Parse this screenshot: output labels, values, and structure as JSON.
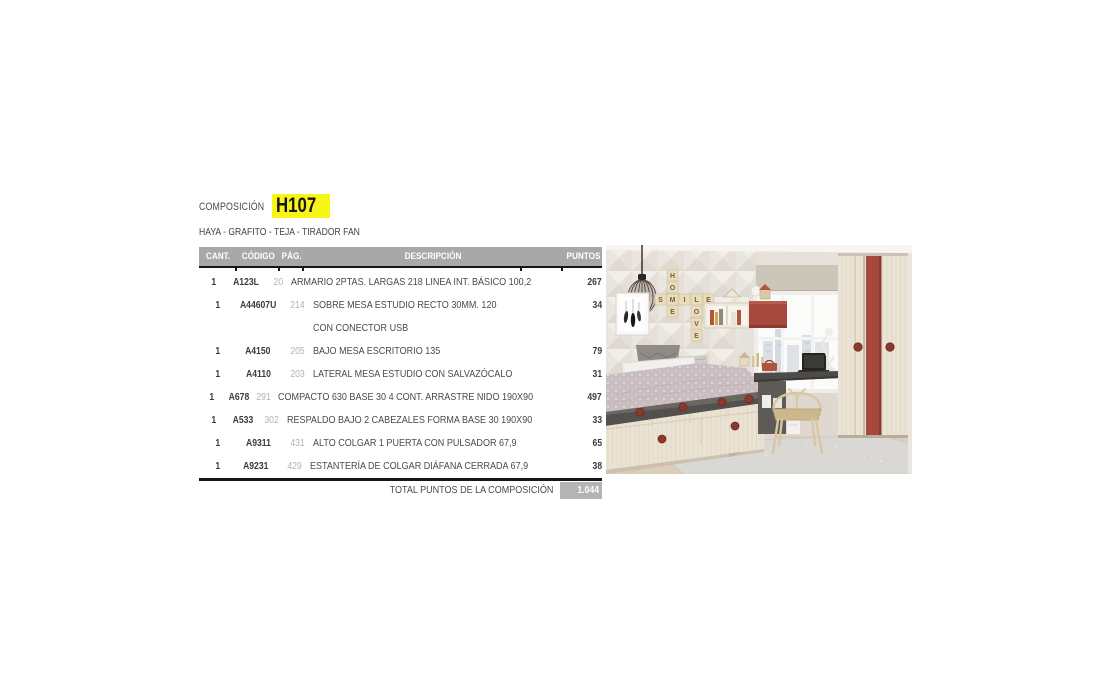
{
  "page": {
    "composition_label": "COMPOSICIÓN",
    "composition_code": "H107",
    "finishes": "HAYA - GRAFITO - TEJA - TIRADOR FAN"
  },
  "table": {
    "headers": {
      "cant": "CANT.",
      "codigo": "CÓDIGO",
      "pag": "PÁG.",
      "descripcion": "DESCRIPCIÓN",
      "puntos": "PUNTOS"
    },
    "rows": [
      {
        "cant": "1",
        "codigo": "A123L",
        "pag": "20",
        "descripcion": "ARMARIO 2PTAS. LARGAS 218 LINEA INT. BÁSICO 100,2",
        "puntos": "267"
      },
      {
        "cant": "1",
        "codigo": "A44607U",
        "pag": "214",
        "descripcion": "SOBRE MESA ESTUDIO RECTO 30MM. 120",
        "descripcion2": "CON CONECTOR USB",
        "puntos": "34"
      },
      {
        "cant": "1",
        "codigo": "A4150",
        "pag": "205",
        "descripcion": "BAJO MESA ESCRITORIO 135",
        "puntos": "79"
      },
      {
        "cant": "1",
        "codigo": "A4110",
        "pag": "203",
        "descripcion": "LATERAL MESA ESTUDIO CON SALVAZÓCALO",
        "puntos": "31"
      },
      {
        "cant": "1",
        "codigo": "A678",
        "pag": "291",
        "descripcion": "COMPACTO 630 BASE 30 4 CONT. ARRASTRE NIDO 190X90",
        "puntos": "497"
      },
      {
        "cant": "1",
        "codigo": "A533",
        "pag": "302",
        "descripcion": "RESPALDO BAJO 2 CABEZALES FORMA BASE 30 190X90",
        "puntos": "33"
      },
      {
        "cant": "1",
        "codigo": "A9311",
        "pag": "431",
        "descripcion": "ALTO COLGAR 1 PUERTA CON PULSADOR 67,9",
        "puntos": "65"
      },
      {
        "cant": "1",
        "codigo": "A9231",
        "pag": "429",
        "descripcion": "ESTANTERÍA DE COLGAR DIÁFANA CERRADA 67,9",
        "puntos": "38"
      }
    ],
    "total_label": "TOTAL PUNTOS DE LA COMPOSICIÓN",
    "total_value": "1.044"
  },
  "photo": {
    "scrabble": [
      "H",
      "O",
      "M",
      "E",
      "S",
      "I",
      "L",
      "E",
      "O",
      "V",
      "E"
    ],
    "colors": {
      "accent_red": "#a6483d",
      "highlight_yellow": "#f8f415",
      "header_grey": "#a8a8a8",
      "total_box_grey": "#b4b4b4",
      "graphite": "#53504d",
      "wood_light": "#eae3d4"
    }
  }
}
